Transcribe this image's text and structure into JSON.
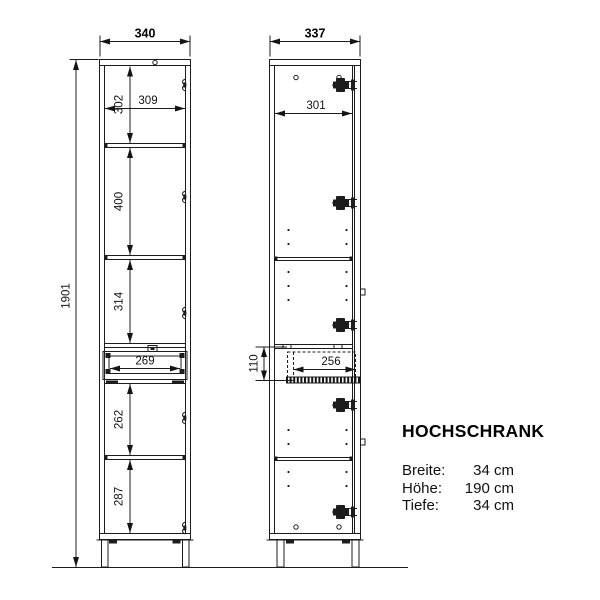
{
  "product": {
    "title": "HOCHSCHRANK",
    "specs": [
      {
        "label": "Breite:",
        "value": "34 cm"
      },
      {
        "label": "Höhe:",
        "value": "190 cm"
      },
      {
        "label": "Tiefe:",
        "value": "34 cm"
      }
    ]
  },
  "front_view": {
    "top_width": "340",
    "total_height": "1901",
    "section_1_height": "302",
    "inner_width": "309",
    "section_2_height": "400",
    "section_3_height": "314",
    "drawer_front_width": "269",
    "section_4_height": "262",
    "section_5_height": "287"
  },
  "side_view": {
    "top_depth": "337",
    "inner_depth": "301",
    "drawer_height": "110",
    "drawer_inner_depth": "256"
  }
}
